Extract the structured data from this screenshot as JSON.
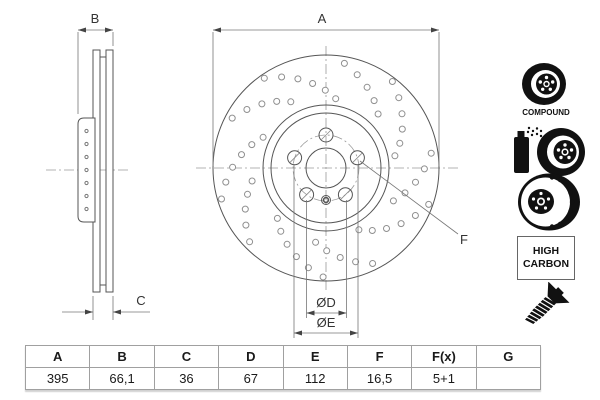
{
  "drawing": {
    "labels": {
      "a": "A",
      "b": "B",
      "c": "C",
      "d": "ØD",
      "e": "ØE",
      "f": "F"
    }
  },
  "icons": {
    "compound_label": "COMPOUND",
    "high_carbon": {
      "line1": "HIGH",
      "line2": "CARBON"
    }
  },
  "table": {
    "headers": [
      "A",
      "B",
      "C",
      "D",
      "E",
      "F",
      "F(x)",
      "G"
    ],
    "values": [
      "395",
      "66,1",
      "36",
      "67",
      "112",
      "16,5",
      "5+1",
      ""
    ]
  },
  "colors": {
    "line": "#555555",
    "thin_line": "#777777",
    "centerline": "#9a9a9a",
    "dimple": "#8f8f8f",
    "icon": "#111111",
    "table_border": "#a0a0a0",
    "background": "#ffffff"
  }
}
